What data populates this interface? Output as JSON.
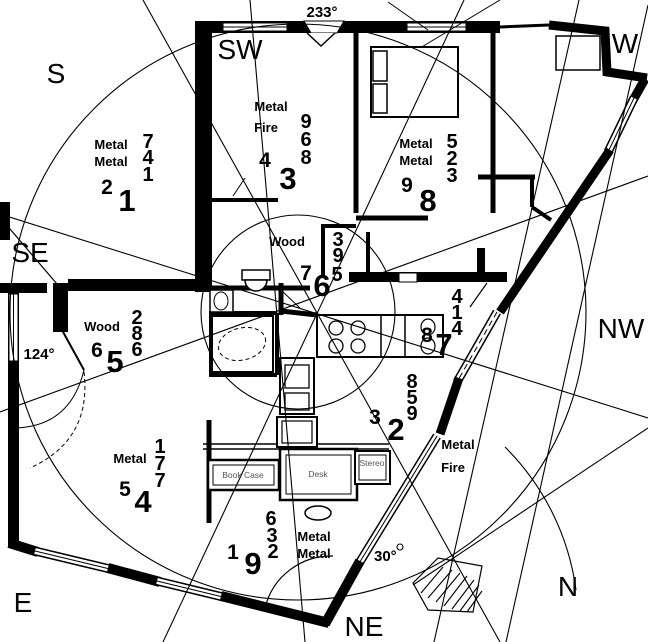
{
  "compass": {
    "s": "S",
    "sw": "SW",
    "w": "W",
    "se": "SE",
    "nw": "NW",
    "e": "E",
    "ne": "NE",
    "n": "N"
  },
  "angles": {
    "facing": "233°",
    "entry": "124°",
    "ne": "30°"
  },
  "sectors": {
    "top_left": {
      "element1": "Metal",
      "element2": "Metal",
      "stack": [
        "7",
        "4",
        "1"
      ],
      "left": "2",
      "base": "1"
    },
    "top_center": {
      "element1": "Metal",
      "element2": "Fire",
      "stack": [
        "9",
        "6",
        "8"
      ],
      "left": "4",
      "base": "3"
    },
    "top_right": {
      "element1": "Metal",
      "element2": "Metal",
      "stack": [
        "5",
        "2",
        "3"
      ],
      "left": "9",
      "base": "8"
    },
    "center": {
      "element1": "Wood",
      "stack": [
        "3",
        "9",
        "5"
      ],
      "left": "7",
      "base": "6"
    },
    "mid_left": {
      "element1": "Wood",
      "stack": [
        "2",
        "8",
        "6"
      ],
      "left": "6",
      "base": "5"
    },
    "mid_right": {
      "stack": [
        "4",
        "1",
        "4"
      ],
      "left": "8",
      "base": "7"
    },
    "center_low": {
      "stack": [
        "8",
        "5",
        "9"
      ],
      "left": "3",
      "base": "2"
    },
    "bottom_left": {
      "element1": "Metal",
      "stack": [
        "1",
        "7",
        "7"
      ],
      "left": "5",
      "base": "4"
    },
    "bottom_mid": {
      "element1": "Metal",
      "element2": "Metal",
      "stack": [
        "6",
        "3",
        "2"
      ],
      "left": "1",
      "base": "9"
    },
    "bottom_right": {
      "element1": "Metal",
      "element2": "Fire"
    }
  },
  "furniture": {
    "desk": "Desk",
    "bookcase": "Book Case",
    "stereo": "Stereo"
  }
}
